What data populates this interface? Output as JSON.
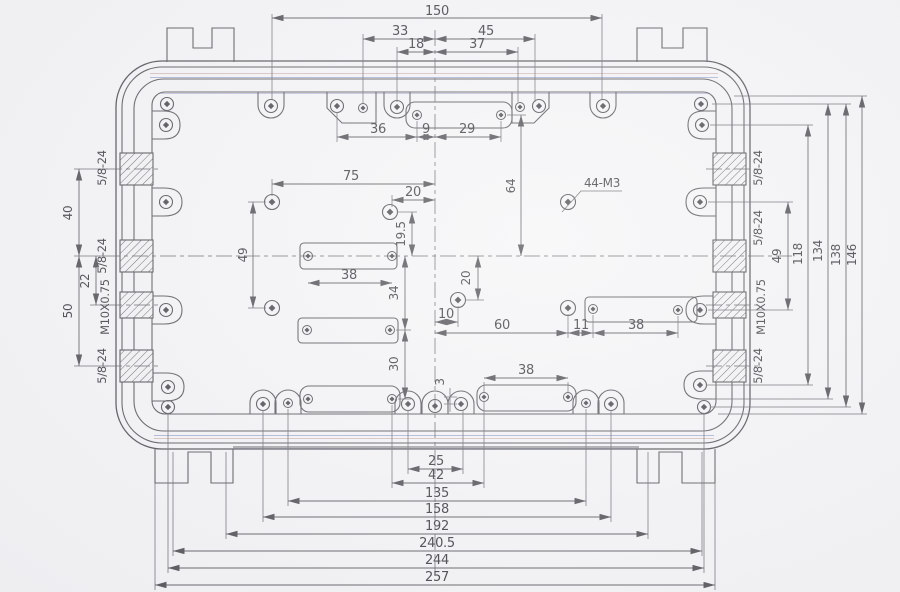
{
  "colors": {
    "paper": "#f4f4f6",
    "ink": "#3c3c42"
  },
  "dims": {
    "top": {
      "d150": "150",
      "d33": "33",
      "d45": "45",
      "d18": "18",
      "d37": "37",
      "d36": "36",
      "d9": "9",
      "d29": "29"
    },
    "interior": {
      "d75": "75",
      "d20_top": "20",
      "d64": "64",
      "d49_left": "49",
      "d19_5": "19.5",
      "d34": "34",
      "d30": "30",
      "d38_left": "38",
      "d20_mid": "20",
      "d10": "10",
      "d60": "60",
      "d11": "11",
      "d38_right": "38",
      "d38_bottom": "38",
      "d3": "3"
    },
    "left": {
      "d40": "40",
      "d22": "22",
      "d50": "50"
    },
    "right": {
      "d49": "49",
      "d118": "118",
      "d134": "134",
      "d138": "138",
      "d146": "146"
    },
    "bottom": {
      "d25": "25",
      "d42": "42",
      "d135": "135",
      "d158": "158",
      "d192": "192",
      "d240_5": "240.5",
      "d244": "244",
      "d257": "257"
    }
  },
  "threads": {
    "left": {
      "t1": "5/8-24",
      "t2": "5/8-24",
      "t3": "M10X0.75",
      "t4": "5/8-24"
    },
    "right": {
      "t1": "5/8-24",
      "t2": "5/8-24",
      "t3": "M10X0.75",
      "t4": "5/8-24"
    }
  },
  "callouts": {
    "m3_holes": "44-M3"
  }
}
